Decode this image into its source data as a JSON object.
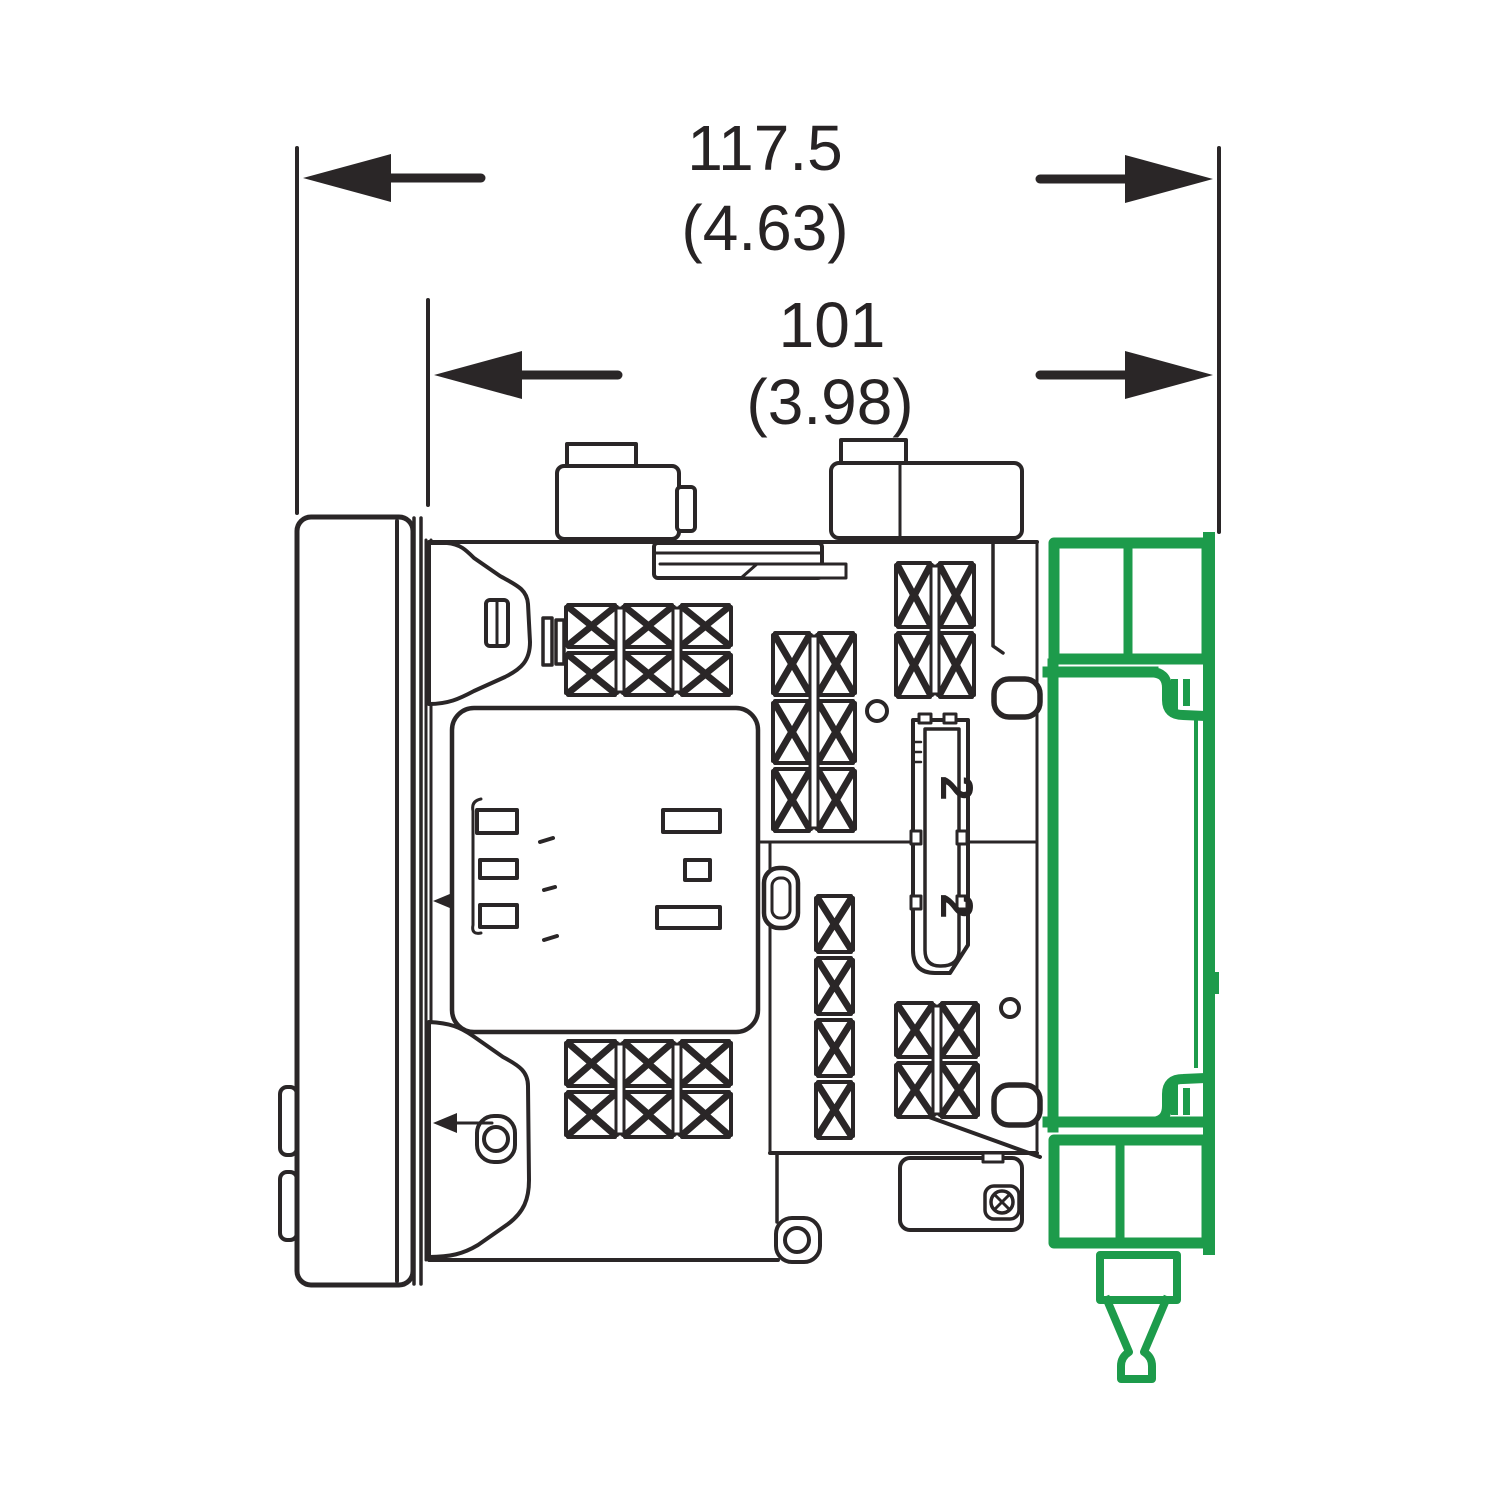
{
  "drawing": {
    "kind": "technical-dimension-drawing",
    "description": "Side view of a panel-mounted device; green DIN-rail adapter highlighted at rear",
    "dimensions": {
      "overall_depth": {
        "mm": "117.5",
        "inch": "(4.63)"
      },
      "behind_panel_depth": {
        "mm": "101",
        "inch": "(3.98)"
      }
    },
    "terminal_labels": {
      "upper": "2",
      "lower": "2"
    },
    "colors": {
      "line": "#2a2627",
      "highlight_green": "#1d9b4b",
      "background": "#ffffff"
    }
  }
}
